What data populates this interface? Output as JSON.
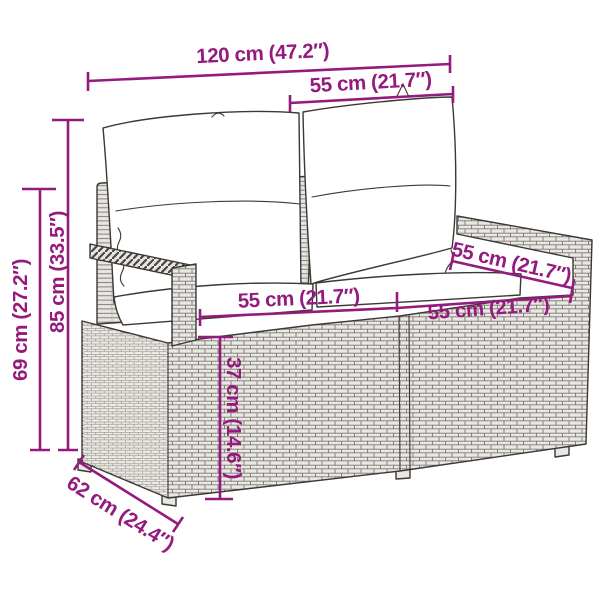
{
  "diagram": {
    "subject": "poly rattan 2-seater garden sofa with back and seat cushions, line drawing with dimension arrows",
    "style": {
      "accent_color": "#941B7D",
      "outline_color": "#3B3835",
      "rattan_fill": "#EAE8E4",
      "background": "#FFFFFF"
    },
    "dimensions": {
      "total_width": "120 cm (47.2″)",
      "back_cushion_width": "55 cm (21.7″)",
      "total_height": "85 cm (33.5″)",
      "armrest_height": "69 cm (27.2″)",
      "armrest_depth": "55 cm (21.7″)",
      "seat_width_left": "55 cm (21.7″)",
      "seat_width_right": "55 cm (21.7″)",
      "seat_height": "37 cm (14.6″)",
      "total_depth": "62 cm (24.4″)"
    }
  }
}
